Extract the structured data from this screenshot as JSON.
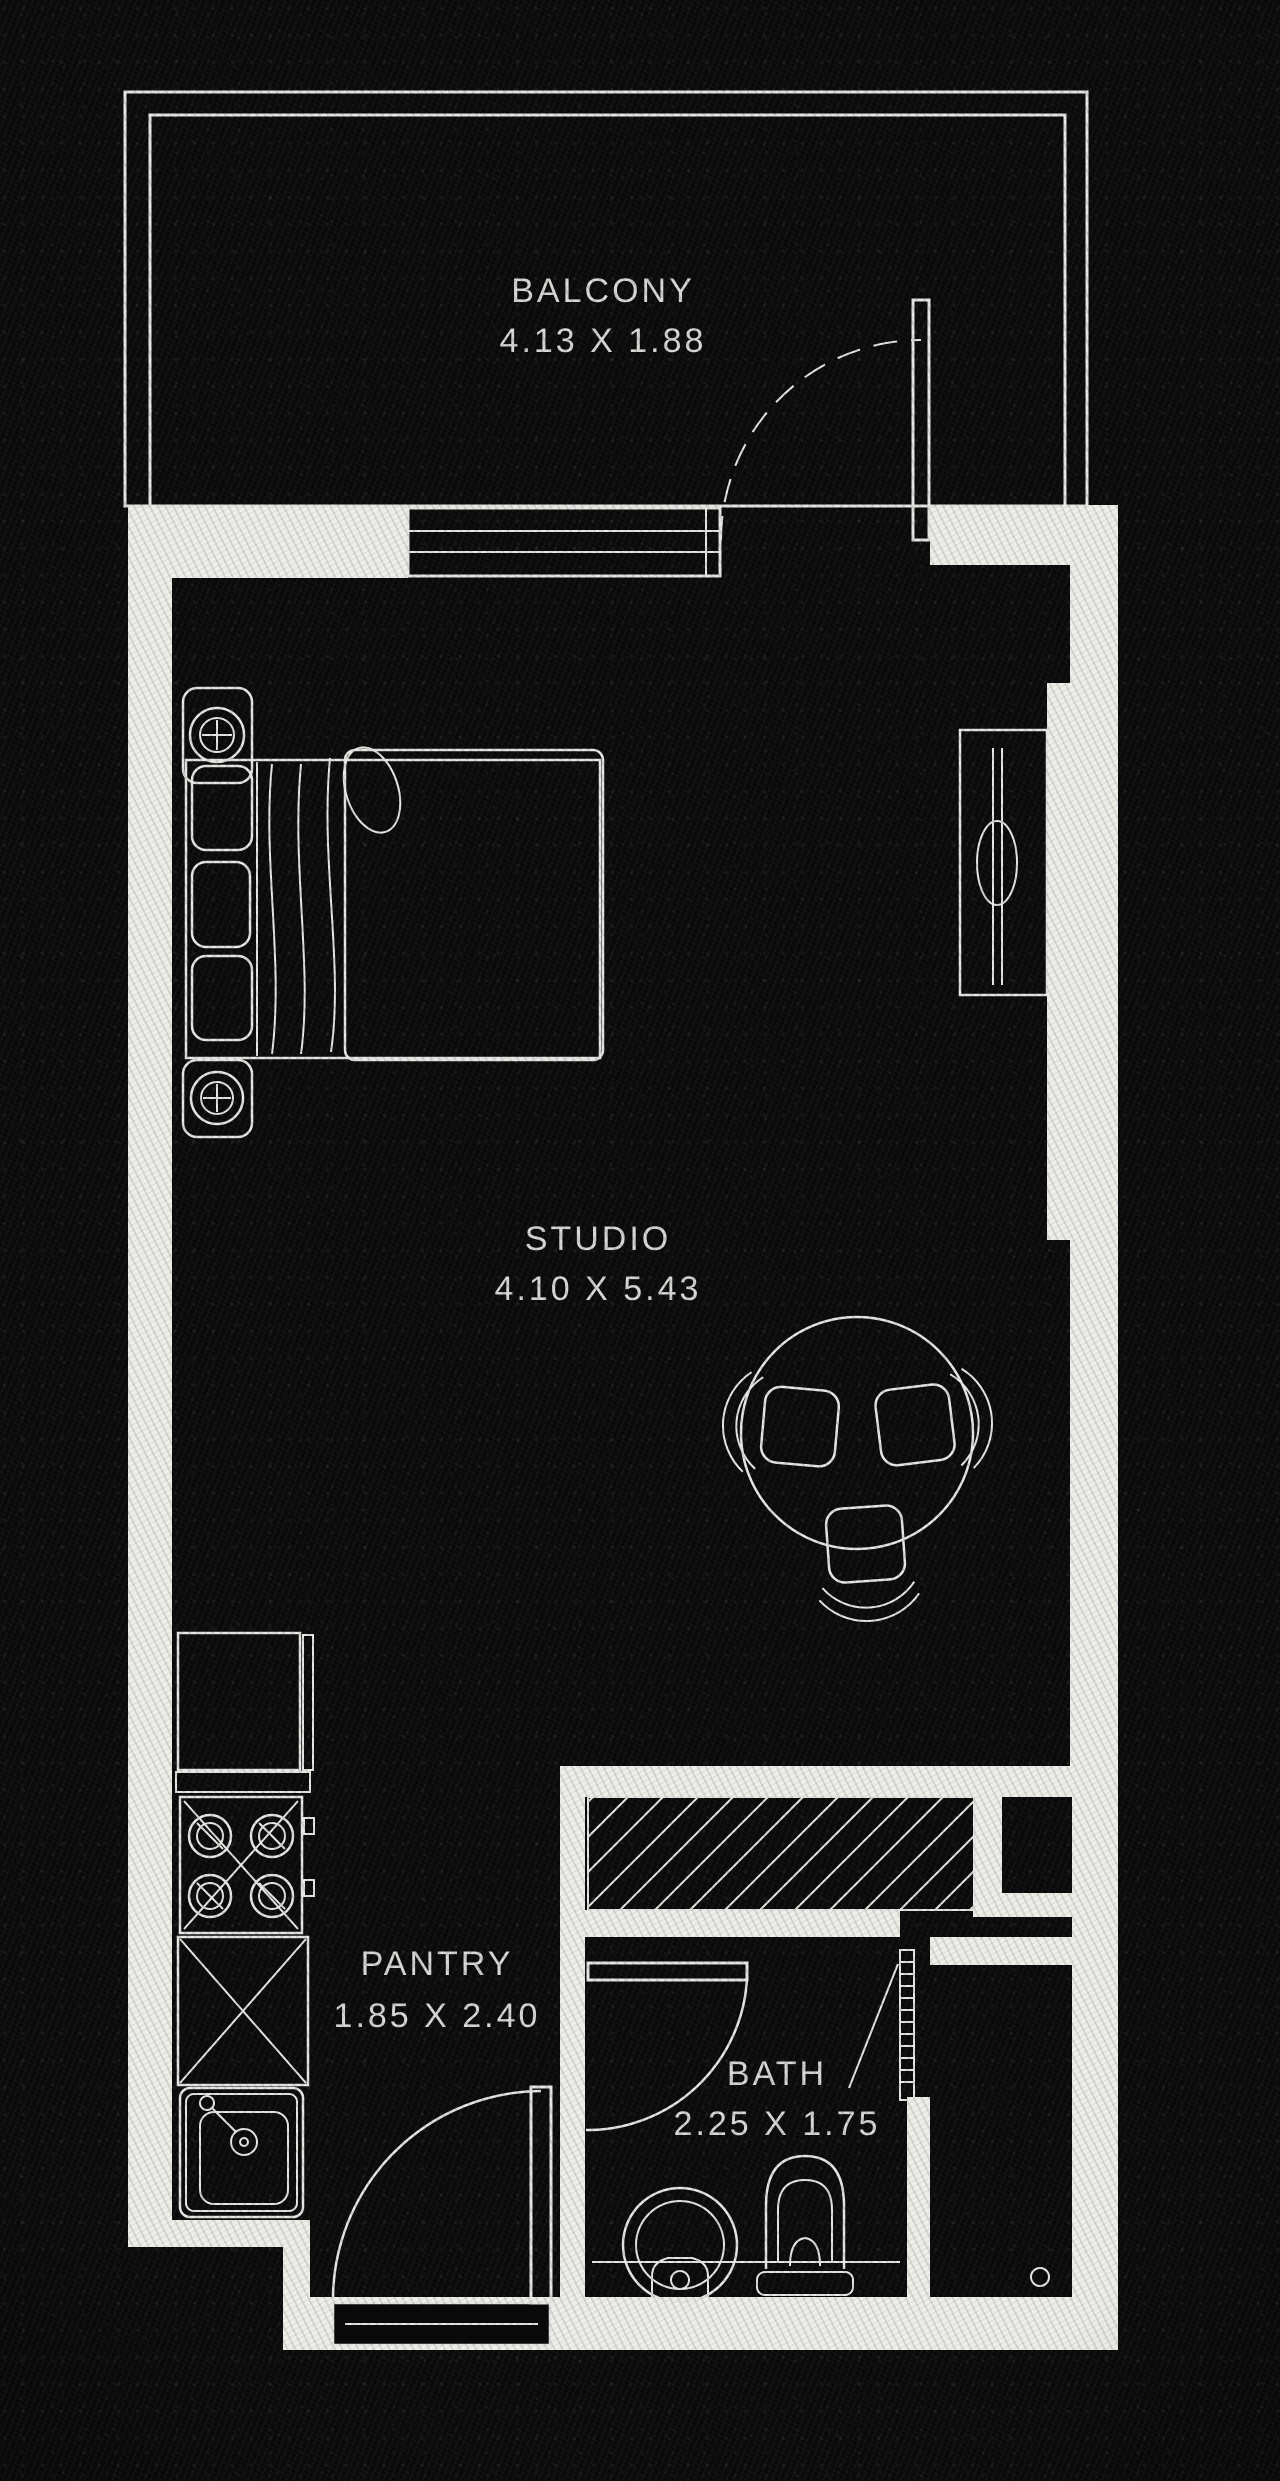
{
  "title": "Studio Apartment Floor Plan",
  "colors": {
    "background": "#0a0a0b",
    "wall": "#efeee9",
    "line": "#e8e7e4",
    "text": "#d9d8d5"
  },
  "rooms": {
    "balcony": {
      "label": "BALCONY",
      "dimensions": "4.13 X 1.88"
    },
    "studio": {
      "label": "STUDIO",
      "dimensions": "4.10 X 5.43"
    },
    "pantry": {
      "label": "PANTRY",
      "dimensions": "1.85 X 2.40"
    },
    "bath": {
      "label": "BATH",
      "dimensions": "2.25 X 1.75"
    }
  }
}
